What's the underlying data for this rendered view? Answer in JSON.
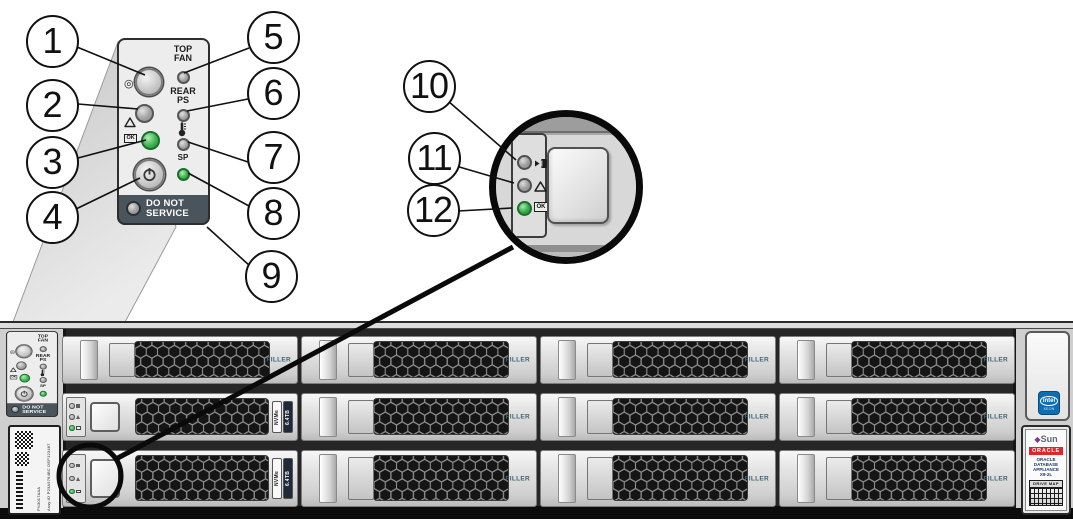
{
  "callouts": [
    "1",
    "2",
    "3",
    "4",
    "5",
    "6",
    "7",
    "8",
    "9",
    "10",
    "11",
    "12"
  ],
  "control_panel": {
    "top_fan": [
      "TOP",
      "FAN"
    ],
    "rear_ps": [
      "REAR",
      "PS"
    ],
    "sp_label": "SP",
    "ok_label": "OK",
    "do_not_service": [
      "DO NOT",
      "SERVICE"
    ]
  },
  "drive_indicator": {
    "ok_label": "OK"
  },
  "chassis": {
    "bays": [
      {
        "type": "filler",
        "label": "FILLER"
      },
      {
        "type": "filler",
        "label": "FILLER"
      },
      {
        "type": "filler",
        "label": "FILLER"
      },
      {
        "type": "filler",
        "label": "FILLER"
      },
      {
        "type": "nvme",
        "label": "NVMe",
        "capacity": "6.4TB"
      },
      {
        "type": "filler",
        "label": "FILLER"
      },
      {
        "type": "filler",
        "label": "FILLER"
      },
      {
        "type": "filler",
        "label": "FILLER"
      },
      {
        "type": "nvme",
        "label": "NVMe",
        "capacity": "6.4TB"
      },
      {
        "type": "filler",
        "label": "FILLER"
      },
      {
        "type": "filler",
        "label": "FILLER"
      },
      {
        "type": "filler",
        "label": "FILLER"
      }
    ],
    "left_label": {
      "line1": "PN3017AAA",
      "line2": "Assy-ID P23A5764BC DEP123487"
    },
    "right_ear": {
      "intel_brand": "intel",
      "intel_line": "XEON",
      "sun_logo": "Sun",
      "oracle_bar": "ORACLE",
      "product": [
        "ORACLE",
        "DATABASE",
        "APPLIANCE",
        "X9-2L"
      ],
      "drive_map": "DRIVE MAP"
    }
  },
  "colors": {
    "led_green": "#3bb24b",
    "dns_bar": "#4a545c",
    "oracle_red": "#e0262d",
    "intel_blue": "#0f6db4",
    "filler_text": "#3f6474"
  }
}
